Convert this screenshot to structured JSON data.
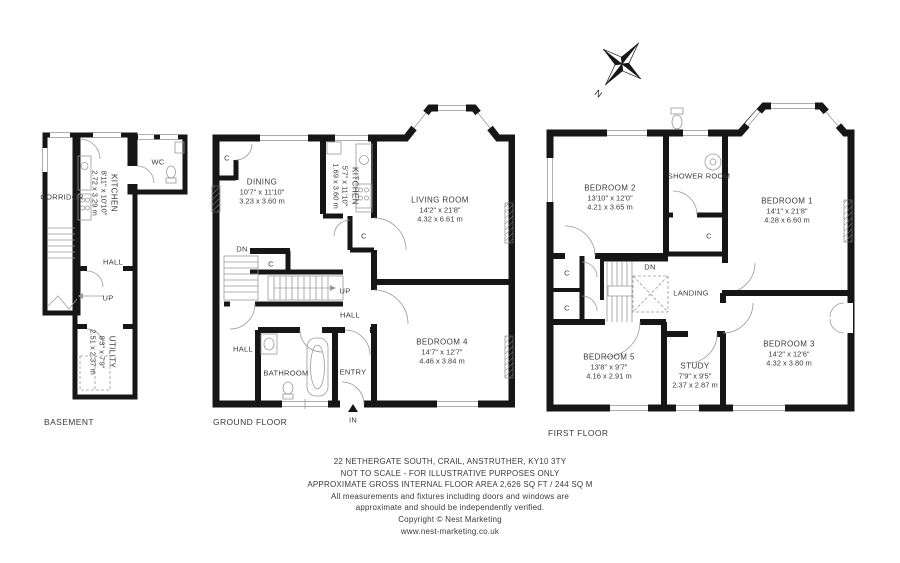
{
  "compass": {
    "north": "N"
  },
  "labels": {
    "closet": "C",
    "down": "DN",
    "up": "UP",
    "hall": "HALL",
    "in": "IN",
    "wc": "WC",
    "entry": "ENTRY",
    "landing": "LANDING",
    "corridor": "CORRIDOR",
    "bathroom": "BATHROOM",
    "shower_room": "SHOWER ROOM"
  },
  "floors": [
    {
      "label": "BASEMENT",
      "rooms": [
        {
          "name": "KITCHEN",
          "imperial": "8'11\" x 10'10\"",
          "metric": "2.72 x 3.29 m"
        },
        {
          "name": "UTILITY",
          "imperial": "8'3\" x 7'9\"",
          "metric": "2.51 x 2.37 m"
        }
      ]
    },
    {
      "label": "GROUND FLOOR",
      "rooms": [
        {
          "name": "DINING",
          "imperial": "10'7\" x 11'10\"",
          "metric": "3.23 x 3.60 m"
        },
        {
          "name": "KITCHEN",
          "imperial": "5'7\" x 11'10\"",
          "metric": "1.69 x 3.60 m"
        },
        {
          "name": "LIVING ROOM",
          "imperial": "14'2\" x 21'8\"",
          "metric": "4.32 x 6.61 m"
        },
        {
          "name": "BEDROOM 4",
          "imperial": "14'7\" x 12'7\"",
          "metric": "4.46 x 3.84 m"
        }
      ]
    },
    {
      "label": "FIRST FLOOR",
      "rooms": [
        {
          "name": "BEDROOM 2",
          "imperial": "13'10\" x 12'0\"",
          "metric": "4.21 x 3.65 m"
        },
        {
          "name": "BEDROOM 1",
          "imperial": "14'1\" x 21'8\"",
          "metric": "4.28 x 6.60 m"
        },
        {
          "name": "BEDROOM 5",
          "imperial": "13'8\" x 9'7\"",
          "metric": "4.16 x 2.91 m"
        },
        {
          "name": "STUDY",
          "imperial": "7'9\" x 9'5\"",
          "metric": "2.37 x 2.87 m"
        },
        {
          "name": "BEDROOM 3",
          "imperial": "14'2\" x 12'6\"",
          "metric": "4.32 x 3.80 m"
        }
      ]
    }
  ],
  "footer": {
    "lines": [
      "22 NETHERGATE SOUTH, CRAIL, ANSTRUTHER, KY10 3TY",
      "NOT TO SCALE - FOR ILLUSTRATIVE PURPOSES ONLY",
      "APPROXIMATE GROSS INTERNAL FLOOR AREA 2,626 SQ FT / 244 SQ M",
      "All measurements and fixtures including doors and windows are",
      "approximate and should be independently verified.",
      "Copyright © Nest Marketing",
      "www.nest-marketing.co.uk"
    ]
  }
}
